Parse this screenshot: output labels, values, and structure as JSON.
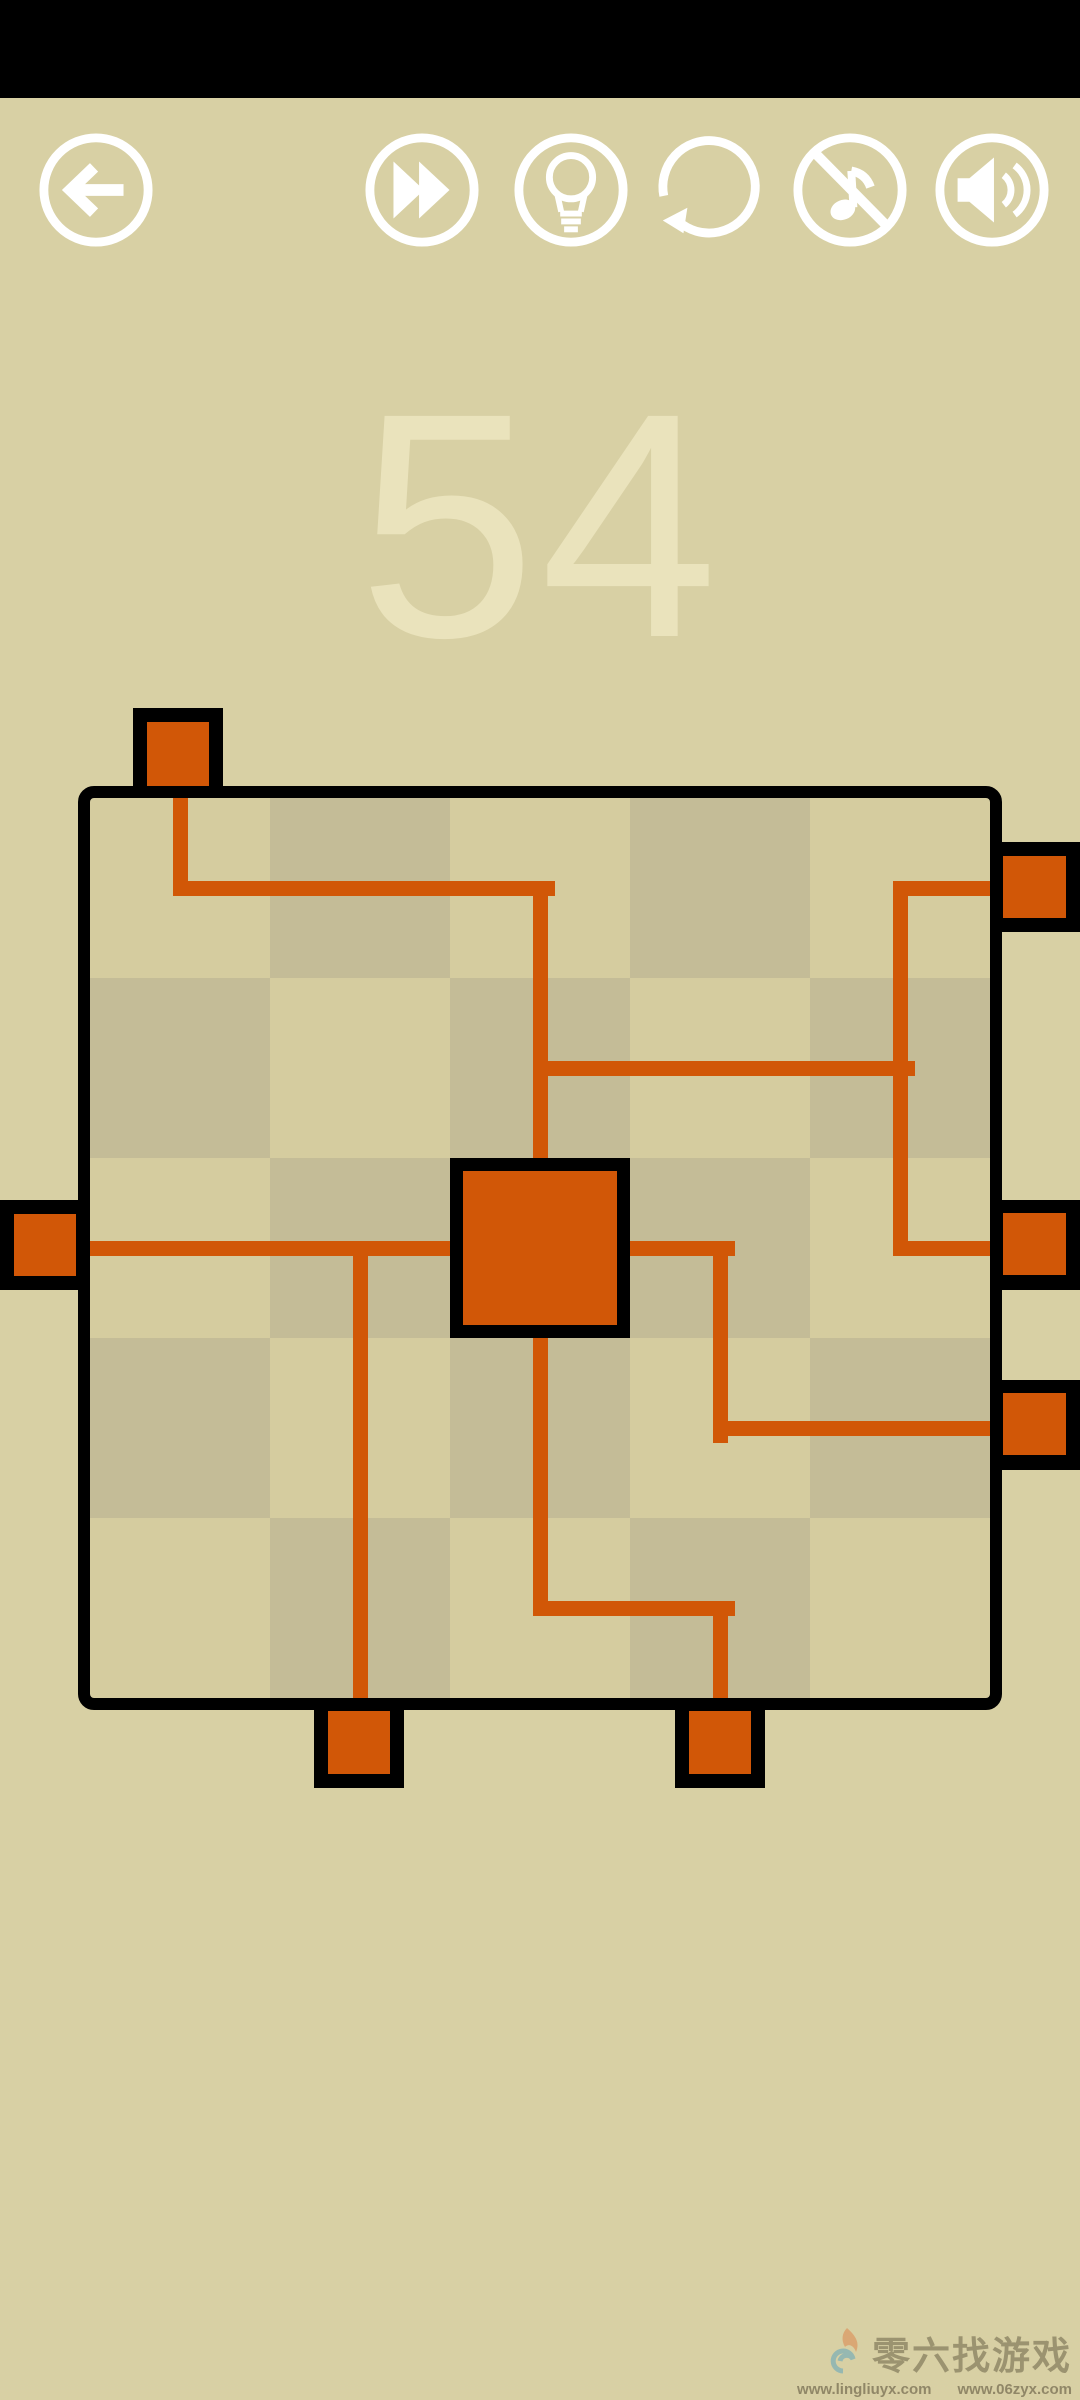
{
  "level": {
    "number": "54"
  },
  "toolbar": {
    "buttons": [
      {
        "id": "back",
        "label": "Back"
      },
      {
        "id": "skip",
        "label": "Skip level"
      },
      {
        "id": "hint",
        "label": "Hint"
      },
      {
        "id": "undo",
        "label": "Restart"
      },
      {
        "id": "music",
        "label": "Music off"
      },
      {
        "id": "sound",
        "label": "Sound on"
      }
    ]
  },
  "colors": {
    "background": "#d8d0a4",
    "statusbar": "#000000",
    "board_light": "#d5cc9f",
    "board_dark": "#c4bc97",
    "board_line": "#000000",
    "wire": "#d15707",
    "block": "#d15707",
    "level_number": "#eae3bc",
    "icon": "#ffffff"
  },
  "game": {
    "grid": {
      "cols": 5,
      "rows": 5,
      "cell": 180,
      "inner_x": 90,
      "inner_y": 798
    },
    "wire_thickness": 15,
    "wires": [
      {
        "x": 173,
        "y": 798,
        "w": 15,
        "h": 98
      },
      {
        "x": 173,
        "y": 881,
        "w": 382,
        "h": 15
      },
      {
        "x": 533,
        "y": 881,
        "w": 15,
        "h": 277
      },
      {
        "x": 533,
        "y": 1061,
        "w": 382,
        "h": 15
      },
      {
        "x": 893,
        "y": 881,
        "w": 15,
        "h": 375
      },
      {
        "x": 893,
        "y": 881,
        "w": 97,
        "h": 15
      },
      {
        "x": 893,
        "y": 1241,
        "w": 97,
        "h": 15
      },
      {
        "x": 90,
        "y": 1241,
        "w": 360,
        "h": 15
      },
      {
        "x": 353,
        "y": 1241,
        "w": 15,
        "h": 457
      },
      {
        "x": 533,
        "y": 1338,
        "w": 15,
        "h": 278
      },
      {
        "x": 533,
        "y": 1601,
        "w": 202,
        "h": 15
      },
      {
        "x": 713,
        "y": 1601,
        "w": 15,
        "h": 97
      },
      {
        "x": 630,
        "y": 1241,
        "w": 105,
        "h": 15
      },
      {
        "x": 713,
        "y": 1241,
        "w": 15,
        "h": 202
      },
      {
        "x": 713,
        "y": 1421,
        "w": 277,
        "h": 15
      }
    ],
    "edge_blocks": [
      {
        "id": "top-1",
        "outer": {
          "x": 133,
          "y": 708,
          "w": 90,
          "h": 90
        },
        "inner": {
          "x": 14,
          "y": 14,
          "w": 62,
          "h": 64
        }
      },
      {
        "id": "left-1",
        "outer": {
          "x": 0,
          "y": 1200,
          "w": 90,
          "h": 90
        },
        "inner": {
          "x": 14,
          "y": 14,
          "w": 62,
          "h": 62
        }
      },
      {
        "id": "right-1",
        "outer": {
          "x": 990,
          "y": 842,
          "w": 90,
          "h": 90
        },
        "inner": {
          "x": 13,
          "y": 14,
          "w": 63,
          "h": 62
        }
      },
      {
        "id": "right-2",
        "outer": {
          "x": 990,
          "y": 1200,
          "w": 90,
          "h": 90
        },
        "inner": {
          "x": 13,
          "y": 13,
          "w": 63,
          "h": 62
        }
      },
      {
        "id": "right-3",
        "outer": {
          "x": 990,
          "y": 1380,
          "w": 90,
          "h": 90
        },
        "inner": {
          "x": 13,
          "y": 13,
          "w": 63,
          "h": 62
        }
      },
      {
        "id": "bottom-1",
        "outer": {
          "x": 314,
          "y": 1698,
          "w": 90,
          "h": 90
        },
        "inner": {
          "x": 14,
          "y": 13,
          "w": 62,
          "h": 63
        }
      },
      {
        "id": "bottom-2",
        "outer": {
          "x": 675,
          "y": 1698,
          "w": 90,
          "h": 90
        },
        "inner": {
          "x": 14,
          "y": 13,
          "w": 62,
          "h": 63
        }
      }
    ],
    "center_block": {
      "x": 450,
      "y": 1158,
      "w": 180,
      "h": 180
    }
  },
  "watermark": {
    "brand": "零六找游戏",
    "url1": "www.lingliuyx.com",
    "url2": "www.06zyx.com"
  }
}
